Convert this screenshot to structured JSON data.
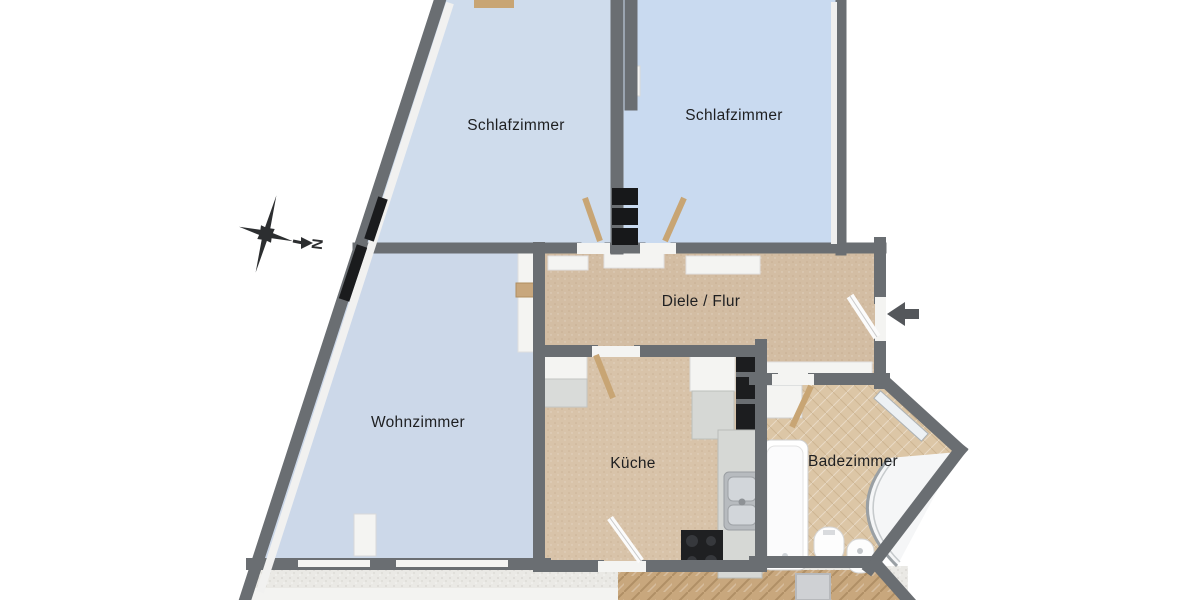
{
  "meta": {
    "type": "floor-plan",
    "language": "de"
  },
  "rooms": {
    "schlafzimmer_left": {
      "label": "Schlafzimmer"
    },
    "schlafzimmer_right": {
      "label": "Schlafzimmer"
    },
    "diele_flur": {
      "label": "Diele / Flur"
    },
    "wohnzimmer": {
      "label": "Wohnzimmer"
    },
    "kueche": {
      "label": "Küche"
    },
    "badezimmer": {
      "label": "Badezimmer"
    }
  },
  "compass": {
    "north_label": "N"
  },
  "colors": {
    "wall": "#6a6e72",
    "floor_bedroom_left": "#cfdcec",
    "floor_bedroom_right": "#c9daf0",
    "floor_living": "#ccd8e9",
    "floor_hall": "#d3bda3",
    "floor_kitchen": "#d8c3a9",
    "floor_bath": "#dcc6a6",
    "wood_door": "#c8a574",
    "label_text": "#1e1f21"
  }
}
